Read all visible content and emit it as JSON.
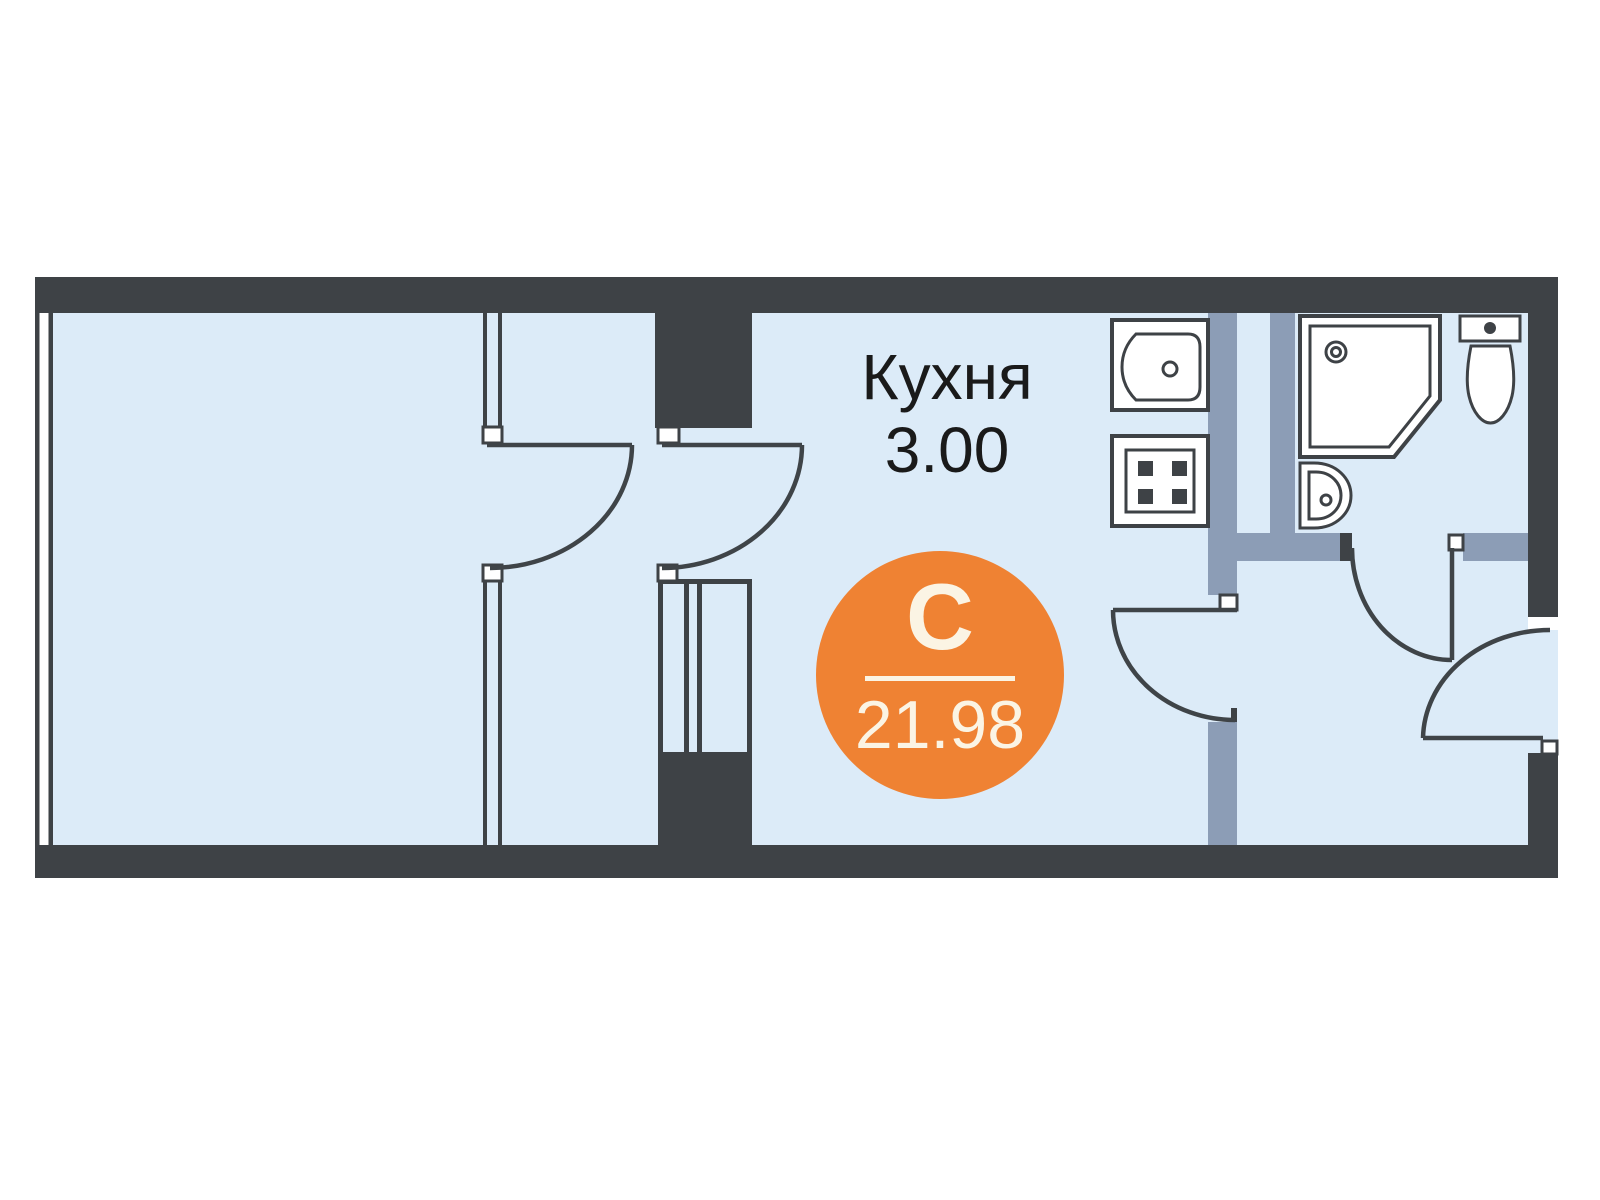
{
  "page": {
    "background": "#ffffff"
  },
  "plan": {
    "kind": "studio-apartment-floor-plan",
    "kitchen_label": "Кухня",
    "kitchen_area": "3.00",
    "unit_type_letter": "С",
    "total_area": "21.98",
    "colors": {
      "wall_dark": "#3e4246",
      "wall_gray": "#8c9db6",
      "floor": "#dcebf8",
      "line": "#3f4448",
      "fixture": "#ffffff",
      "accent": "#ef8233",
      "badge_text": "#fbf4e4",
      "label_text": "#1a1a1a",
      "page_bg": "#ffffff"
    },
    "fixtures": [
      {
        "name": "kitchen-sink"
      },
      {
        "name": "stove"
      },
      {
        "name": "shower"
      },
      {
        "name": "washbasin"
      },
      {
        "name": "toilet"
      }
    ]
  }
}
